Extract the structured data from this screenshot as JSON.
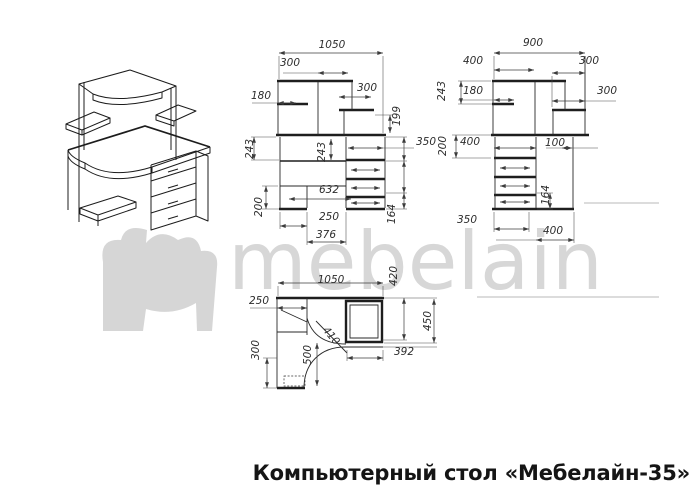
{
  "title": "Компьютерный стол «Мебелайн-35»",
  "watermark": {
    "text": "mebelain",
    "color": "#d7d7d7"
  },
  "colors": {
    "line": "#1e1e1e",
    "dim_text": "#2d2d2d",
    "title": "#151515"
  },
  "views": {
    "front": {
      "name": "front projection with dimensions (mm)",
      "dims": [
        {
          "text": "1050",
          "x": 332,
          "y": 45,
          "rot": 0
        },
        {
          "text": "300",
          "x": 290,
          "y": 63,
          "rot": 0
        },
        {
          "text": "180",
          "x": 261,
          "y": 96,
          "rot": 0
        },
        {
          "text": "300",
          "x": 367,
          "y": 88,
          "rot": 0
        },
        {
          "text": "199",
          "x": 397,
          "y": 116,
          "rot": -90
        },
        {
          "text": "243",
          "x": 250,
          "y": 149,
          "rot": -90
        },
        {
          "text": "243",
          "x": 322,
          "y": 152,
          "rot": -90
        },
        {
          "text": "350",
          "x": 426,
          "y": 142,
          "rot": 0
        },
        {
          "text": "632",
          "x": 329,
          "y": 190,
          "rot": 0
        },
        {
          "text": "200",
          "x": 259,
          "y": 207,
          "rot": -90
        },
        {
          "text": "250",
          "x": 329,
          "y": 217,
          "rot": 0
        },
        {
          "text": "376",
          "x": 326,
          "y": 235,
          "rot": 0
        },
        {
          "text": "164",
          "x": 392,
          "y": 214,
          "rot": -90
        }
      ]
    },
    "side": {
      "name": "side projection with dimensions (mm)",
      "dims": [
        {
          "text": "900",
          "x": 533,
          "y": 43,
          "rot": 0
        },
        {
          "text": "400",
          "x": 473,
          "y": 61,
          "rot": 0
        },
        {
          "text": "300",
          "x": 589,
          "y": 61,
          "rot": 0
        },
        {
          "text": "243",
          "x": 442,
          "y": 91,
          "rot": -90
        },
        {
          "text": "180",
          "x": 473,
          "y": 91,
          "rot": 0
        },
        {
          "text": "300",
          "x": 607,
          "y": 91,
          "rot": 0
        },
        {
          "text": "200",
          "x": 443,
          "y": 146,
          "rot": -90
        },
        {
          "text": "400",
          "x": 470,
          "y": 142,
          "rot": 0
        },
        {
          "text": "100",
          "x": 555,
          "y": 143,
          "rot": 0
        },
        {
          "text": "164",
          "x": 546,
          "y": 195,
          "rot": -90
        },
        {
          "text": "350",
          "x": 467,
          "y": 220,
          "rot": 0
        },
        {
          "text": "400",
          "x": 553,
          "y": 231,
          "rot": 0
        }
      ]
    },
    "top": {
      "name": "top (plan) projection with dimensions (mm)",
      "dims": [
        {
          "text": "1050",
          "x": 331,
          "y": 280,
          "rot": 0
        },
        {
          "text": "420",
          "x": 394,
          "y": 276,
          "rot": -90
        },
        {
          "text": "250",
          "x": 259,
          "y": 301,
          "rot": 0
        },
        {
          "text": "450",
          "x": 428,
          "y": 321,
          "rot": -90
        },
        {
          "text": "300",
          "x": 256,
          "y": 350,
          "rot": -90
        },
        {
          "text": "410",
          "x": 331,
          "y": 336,
          "rot": 50
        },
        {
          "text": "500",
          "x": 308,
          "y": 355,
          "rot": -90
        },
        {
          "text": "392",
          "x": 404,
          "y": 352,
          "rot": 0
        }
      ]
    }
  }
}
